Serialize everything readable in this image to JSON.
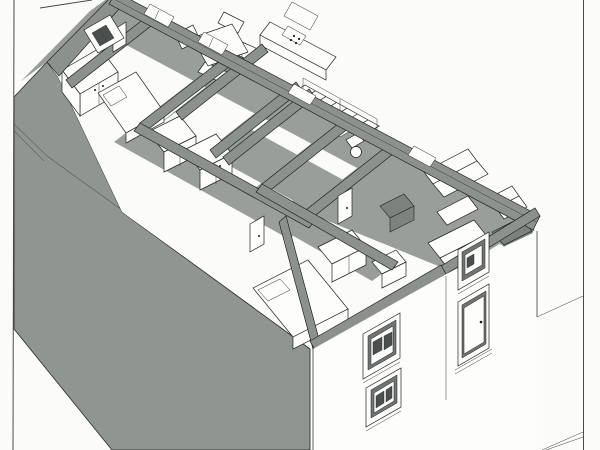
{
  "document": {
    "kind": "architectural-drawing",
    "view": "isometric-cutaway-floor-plan",
    "visible_text_present": false
  },
  "colors": {
    "paper": "#fbfbf9",
    "wall": "#8b918d",
    "mass": "#8f9591",
    "shadow": "#989e9a",
    "recess": "#6e7472",
    "glass": "#4a504d",
    "line": "#222222",
    "border": "#4a4a4a"
  },
  "scene": {
    "page": [
      "left-border-line",
      "right-border-line",
      "top-left-corner-line"
    ],
    "exterior": [
      "back-left-wall",
      "back-right-wall",
      "east-end-wall",
      "front-right-facade",
      "left-side-wall-in-shadow",
      "building-ground-lines"
    ],
    "facade_openings": [
      "recessed-window-upper-left",
      "recessed-window-lower-left",
      "recessed-window-upper-right",
      "recessed-entry-door-with-handle"
    ],
    "rooms": [
      "west-end-room",
      "bedroom-rear-left",
      "dining-room",
      "kitchen",
      "stair-hall",
      "wc",
      "living-room",
      "bedroom-front-left",
      "front-middle-room",
      "corridor"
    ],
    "furniture": [
      "dining-table-with-chairs",
      "kitchen-counter-with-appliances",
      "wall-cabinets",
      "staircase-with-railing",
      "toilet",
      "washbasin",
      "sofa",
      "second-sofa",
      "armchair",
      "coffee-table",
      "sideboard",
      "tv-cabinet",
      "bed-rear",
      "bed-front",
      "wardrobe-west",
      "wardrobe-row-1",
      "wardrobe-row-2",
      "dresser",
      "interior-doors-with-handles"
    ]
  }
}
